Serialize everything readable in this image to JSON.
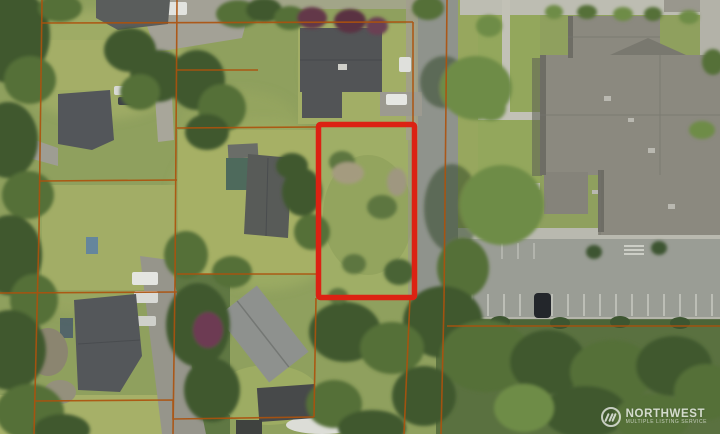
{
  "scene": {
    "type": "aerial-photo",
    "description": "Satellite aerial view of a residential neighborhood: vacant treed lot outlined in red beside a street, orange cadastral parcel lines over house lots on the left, and a large building complex with parking lot across the road on the right.",
    "landmarks": [
      "vacant subject lot",
      "residential houses",
      "street",
      "parking lot",
      "building complex",
      "tree canopy",
      "driveways"
    ]
  },
  "overlay": {
    "subject_parcel": "red rectangle outline on vacant lot",
    "boundary_lines": "thin orange parcel boundary lines"
  },
  "colors": {
    "parcel_highlight": "#dc2213",
    "boundary_line": "#ad520d",
    "road": "#8f938c",
    "roof_dark": "#54575a",
    "roof_light": "#8b897f",
    "grass": "#8fa05e",
    "tree_dark": "#41592f"
  },
  "watermark": {
    "brand": "NORTHWEST",
    "tagline": "MULTIPLE LISTING SERVICE",
    "logo": "nwmls-circle-slashes-icon"
  }
}
